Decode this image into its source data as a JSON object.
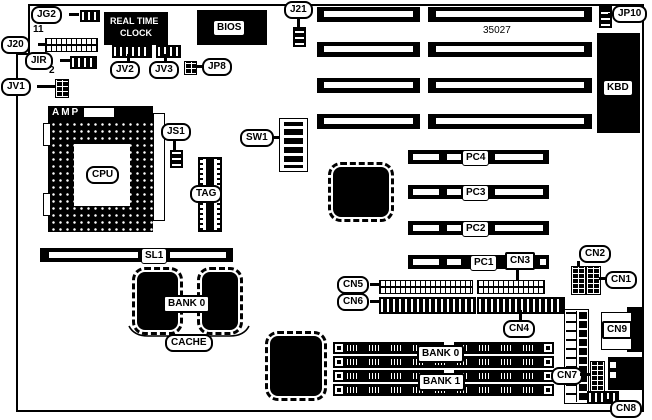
{
  "diagram": {
    "part_number": "35027",
    "labels": {
      "jg2": "JG2",
      "j20": "J20",
      "j20_pin_count": "11",
      "jir": "JIR",
      "jv1": "JV1",
      "jv1_pin_count": "2",
      "jv2": "JV2",
      "jv3": "JV3",
      "jp8": "JP8",
      "j21": "J21",
      "jp10": "JP10",
      "rtc_line1": "REAL TIME",
      "rtc_line2": "CLOCK",
      "bios": "BIOS",
      "kbd": "KBD",
      "amp": "AMP",
      "cpu": "CPU",
      "js1": "JS1",
      "tag": "TAG",
      "sw1": "SW1",
      "sl1": "SL1",
      "cache_bank": "BANK 0",
      "cache": "CACHE",
      "pc1": "PC1",
      "pc2": "PC2",
      "pc3": "PC3",
      "pc4": "PC4",
      "cn1": "CN1",
      "cn2": "CN2",
      "cn3": "CN3",
      "cn4": "CN4",
      "cn5": "CN5",
      "cn6": "CN6",
      "cn7": "CN7",
      "cn8": "CN8",
      "cn9": "CN9",
      "simm_bank0": "BANK 0",
      "simm_bank1": "BANK 1"
    },
    "colors": {
      "ink": "#000000",
      "paper": "#ffffff"
    }
  }
}
